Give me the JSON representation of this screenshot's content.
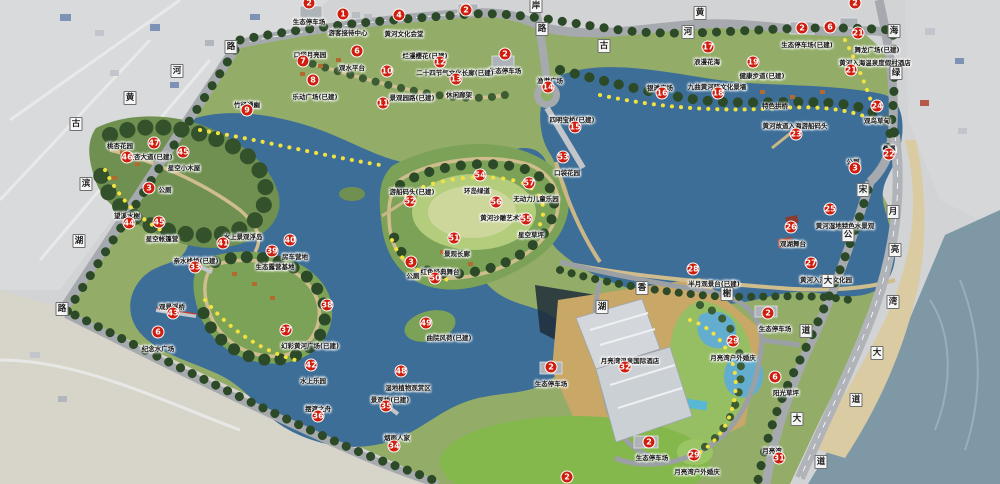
{
  "map": {
    "marker_color": "#cf1d0e",
    "water_color": "#3d6e97",
    "markers": [
      {
        "n": "2",
        "x": 309,
        "y": 3,
        "label": "生态停车场",
        "lx": 309,
        "ly": 16
      },
      {
        "n": "1",
        "x": 343,
        "y": 14,
        "label": "游客接待中心",
        "lx": 348,
        "ly": 27
      },
      {
        "n": "4",
        "x": 399,
        "y": 15,
        "label": "黄河文化会堂",
        "lx": 404,
        "ly": 28
      },
      {
        "n": "2",
        "x": 466,
        "y": 10,
        "label": "",
        "lx": 466,
        "ly": 22
      },
      {
        "n": "2",
        "x": 505,
        "y": 54,
        "label": "生态停车场",
        "lx": 505,
        "ly": 65
      },
      {
        "n": "6",
        "x": 357,
        "y": 51,
        "label": "观水平台",
        "lx": 352,
        "ly": 62
      },
      {
        "n": "7",
        "x": 303,
        "y": 61,
        "label": "口袋月亮园",
        "lx": 310,
        "ly": 49
      },
      {
        "n": "8",
        "x": 313,
        "y": 80,
        "label": "乐动广场(已建)",
        "lx": 315,
        "ly": 91
      },
      {
        "n": "9",
        "x": 247,
        "y": 110,
        "label": "竹径通幽",
        "lx": 247,
        "ly": 99
      },
      {
        "n": "10",
        "x": 387,
        "y": 71,
        "label": "二十四节气文化长廊(已建)",
        "lx": 455,
        "ly": 67
      },
      {
        "n": "11",
        "x": 383,
        "y": 103,
        "label": "景观园路(已建)",
        "lx": 412,
        "ly": 92
      },
      {
        "n": "12",
        "x": 440,
        "y": 62,
        "label": "烂漫樱花(已建)",
        "lx": 425,
        "ly": 50
      },
      {
        "n": "13",
        "x": 456,
        "y": 79,
        "label": "休闲廊架",
        "lx": 459,
        "ly": 89
      },
      {
        "n": "14",
        "x": 548,
        "y": 87,
        "label": "渔港广场",
        "lx": 550,
        "ly": 75
      },
      {
        "n": "15",
        "x": 575,
        "y": 127,
        "label": "四明宝桥(已建)",
        "lx": 572,
        "ly": 114
      },
      {
        "n": "16",
        "x": 662,
        "y": 93,
        "label": "银滩广场",
        "lx": 660,
        "ly": 82
      },
      {
        "n": "17",
        "x": 708,
        "y": 47,
        "label": "浪漫花海",
        "lx": 707,
        "ly": 56
      },
      {
        "n": "18",
        "x": 718,
        "y": 93,
        "label": "九曲黄河阵文化景墙",
        "lx": 717,
        "ly": 81
      },
      {
        "n": "19",
        "x": 753,
        "y": 62,
        "label": "健康步道(已建)",
        "lx": 762,
        "ly": 70
      },
      {
        "n": "23",
        "x": 796,
        "y": 134,
        "label": "黄河故道入海游船码头",
        "lx": 795,
        "ly": 120
      },
      {
        "n": "22",
        "x": 889,
        "y": 154,
        "label": "叠瀑",
        "lx": 889,
        "ly": 143
      },
      {
        "n": "24",
        "x": 877,
        "y": 106,
        "label": "观鸟草甸",
        "lx": 877,
        "ly": 115
      },
      {
        "n": "2",
        "x": 802,
        "y": 28,
        "label": "生态停车场(已建)",
        "lx": 807,
        "ly": 39
      },
      {
        "n": "6",
        "x": 830,
        "y": 27,
        "label": "",
        "lx": 830,
        "ly": 39
      },
      {
        "n": "21",
        "x": 858,
        "y": 33,
        "label": "舞龙广场(已建)",
        "lx": 877,
        "ly": 44
      },
      {
        "n": "21",
        "x": 851,
        "y": 70,
        "label": "黄河入海温泉度假村酒店",
        "lx": 875,
        "ly": 57
      },
      {
        "n": "2",
        "x": 855,
        "y": 3,
        "label": "",
        "lx": 855,
        "ly": 15
      },
      {
        "n": "3",
        "x": 855,
        "y": 168,
        "label": "公厕",
        "lx": 853,
        "ly": 156
      },
      {
        "n": "25",
        "x": 830,
        "y": 209,
        "label": "黄河湿地特色水景观",
        "lx": 845,
        "ly": 220
      },
      {
        "n": "26",
        "x": 791,
        "y": 227,
        "label": "观湖舞台",
        "lx": 793,
        "ly": 238
      },
      {
        "n": "27",
        "x": 811,
        "y": 263,
        "label": "黄河入海口文化园",
        "lx": 826,
        "ly": 274
      },
      {
        "n": "28",
        "x": 693,
        "y": 269,
        "label": "半月观景台(已建)",
        "lx": 714,
        "ly": 278
      },
      {
        "n": "29",
        "x": 733,
        "y": 341,
        "label": "月亮湾户外婚庆",
        "lx": 733,
        "ly": 352
      },
      {
        "n": "29",
        "x": 694,
        "y": 455,
        "label": "月亮湾户外婚庆",
        "lx": 697,
        "ly": 466
      },
      {
        "n": "2",
        "x": 768,
        "y": 313,
        "label": "生态停车场",
        "lx": 775,
        "ly": 323
      },
      {
        "n": "6",
        "x": 775,
        "y": 377,
        "label": "阳光草坪",
        "lx": 786,
        "ly": 387
      },
      {
        "n": "32",
        "x": 625,
        "y": 367,
        "label": "月亮湾温泉国际酒店",
        "lx": 630,
        "ly": 355
      },
      {
        "n": "2",
        "x": 551,
        "y": 367,
        "label": "生态停车场",
        "lx": 551,
        "ly": 378
      },
      {
        "n": "2",
        "x": 649,
        "y": 442,
        "label": "生态停车场",
        "lx": 652,
        "ly": 452
      },
      {
        "n": "31",
        "x": 779,
        "y": 458,
        "label": "月亮湾",
        "lx": 772,
        "ly": 445
      },
      {
        "n": "2",
        "x": 567,
        "y": 477,
        "label": "",
        "lx": 567,
        "ly": 470
      },
      {
        "n": "52",
        "x": 410,
        "y": 201,
        "label": "游船码头(已建)",
        "lx": 412,
        "ly": 186
      },
      {
        "n": "54",
        "x": 480,
        "y": 175,
        "label": "环岛绿道",
        "lx": 477,
        "ly": 185
      },
      {
        "n": "53",
        "x": 563,
        "y": 157,
        "label": "口袋花园",
        "lx": 567,
        "ly": 167
      },
      {
        "n": "57",
        "x": 529,
        "y": 183,
        "label": "无动力儿童乐园",
        "lx": 536,
        "ly": 193
      },
      {
        "n": "56",
        "x": 496,
        "y": 202,
        "label": "黄河沙雕艺术园",
        "lx": 503,
        "ly": 212
      },
      {
        "n": "55",
        "x": 526,
        "y": 219,
        "label": "星空草坪",
        "lx": 531,
        "ly": 229
      },
      {
        "n": "51",
        "x": 454,
        "y": 238,
        "label": "景观长廊",
        "lx": 457,
        "ly": 248
      },
      {
        "n": "3",
        "x": 411,
        "y": 262,
        "label": "公厕",
        "lx": 413,
        "ly": 270
      },
      {
        "n": "50",
        "x": 435,
        "y": 278,
        "label": "红色经典舞台",
        "lx": 440,
        "ly": 266
      },
      {
        "n": "49",
        "x": 426,
        "y": 323,
        "label": "曲院风荷(已建)",
        "lx": 449,
        "ly": 332
      },
      {
        "n": "48",
        "x": 401,
        "y": 371,
        "label": "湿地植物观赏区",
        "lx": 408,
        "ly": 382
      },
      {
        "n": "35",
        "x": 386,
        "y": 406,
        "label": "景观桥(已建)",
        "lx": 390,
        "ly": 394
      },
      {
        "n": "34",
        "x": 394,
        "y": 446,
        "label": "烟雨人家",
        "lx": 397,
        "ly": 432
      },
      {
        "n": "36",
        "x": 318,
        "y": 416,
        "label": "摆渡之舟",
        "lx": 318,
        "ly": 403
      },
      {
        "n": "42",
        "x": 311,
        "y": 365,
        "label": "水上乐园",
        "lx": 313,
        "ly": 375
      },
      {
        "n": "37",
        "x": 286,
        "y": 330,
        "label": "幻彩黄河广场(已建)",
        "lx": 310,
        "ly": 340
      },
      {
        "n": "38",
        "x": 327,
        "y": 305,
        "label": "",
        "lx": 327,
        "ly": 295
      },
      {
        "n": "33",
        "x": 195,
        "y": 267,
        "label": "亲水栈桥(已建)",
        "lx": 196,
        "ly": 255
      },
      {
        "n": "41",
        "x": 223,
        "y": 243,
        "label": "水上景观浮岛",
        "lx": 243,
        "ly": 231
      },
      {
        "n": "40",
        "x": 290,
        "y": 240,
        "label": "房车营地",
        "lx": 295,
        "ly": 251
      },
      {
        "n": "39",
        "x": 272,
        "y": 251,
        "label": "生态露营基地",
        "lx": 275,
        "ly": 261
      },
      {
        "n": "43",
        "x": 173,
        "y": 313,
        "label": "观景浮桥",
        "lx": 172,
        "ly": 301
      },
      {
        "n": "6",
        "x": 158,
        "y": 332,
        "label": "纪念水广场",
        "lx": 158,
        "ly": 343
      },
      {
        "n": "44",
        "x": 129,
        "y": 223,
        "label": "望溪水榭",
        "lx": 127,
        "ly": 210
      },
      {
        "n": "45",
        "x": 159,
        "y": 222,
        "label": "星空帐篷营",
        "lx": 162,
        "ly": 233
      },
      {
        "n": "3",
        "x": 149,
        "y": 188,
        "label": "公厕",
        "lx": 165,
        "ly": 184
      },
      {
        "n": "46",
        "x": 127,
        "y": 157,
        "label": "桃杏花园",
        "lx": 120,
        "ly": 140
      },
      {
        "n": "47",
        "x": 154,
        "y": 143,
        "label": "银杏大道(已建)",
        "lx": 150,
        "ly": 151
      },
      {
        "n": "45",
        "x": 183,
        "y": 152,
        "label": "星空小木屋",
        "lx": 184,
        "ly": 162
      }
    ],
    "road_chars": [
      {
        "c": "路",
        "x": 231,
        "y": 47
      },
      {
        "c": "河",
        "x": 177,
        "y": 71
      },
      {
        "c": "黄",
        "x": 130,
        "y": 98
      },
      {
        "c": "古",
        "x": 76,
        "y": 124
      },
      {
        "c": "滨",
        "x": 86,
        "y": 184
      },
      {
        "c": "湖",
        "x": 79,
        "y": 241
      },
      {
        "c": "路",
        "x": 62,
        "y": 309
      },
      {
        "c": "岸",
        "x": 536,
        "y": 6
      },
      {
        "c": "路",
        "x": 542,
        "y": 29
      },
      {
        "c": "古",
        "x": 604,
        "y": 46
      },
      {
        "c": "黄",
        "x": 700,
        "y": 13
      },
      {
        "c": "河",
        "x": 688,
        "y": 32
      },
      {
        "c": "海",
        "x": 894,
        "y": 31
      },
      {
        "c": "绿",
        "x": 896,
        "y": 73
      },
      {
        "c": "宋",
        "x": 863,
        "y": 190
      },
      {
        "c": "公",
        "x": 848,
        "y": 235
      },
      {
        "c": "大",
        "x": 828,
        "y": 281
      },
      {
        "c": "道",
        "x": 806,
        "y": 331
      },
      {
        "c": "月",
        "x": 893,
        "y": 212
      },
      {
        "c": "亮",
        "x": 895,
        "y": 250
      },
      {
        "c": "湾",
        "x": 893,
        "y": 302
      },
      {
        "c": "大",
        "x": 877,
        "y": 353
      },
      {
        "c": "道",
        "x": 856,
        "y": 400
      },
      {
        "c": "大",
        "x": 797,
        "y": 419
      },
      {
        "c": "道",
        "x": 821,
        "y": 462
      },
      {
        "c": "湖",
        "x": 602,
        "y": 307
      },
      {
        "c": "香",
        "x": 642,
        "y": 288
      },
      {
        "c": "榭",
        "x": 727,
        "y": 294
      }
    ],
    "texts": [
      {
        "t": "特色拱桥",
        "x": 775,
        "y": 100
      }
    ]
  }
}
